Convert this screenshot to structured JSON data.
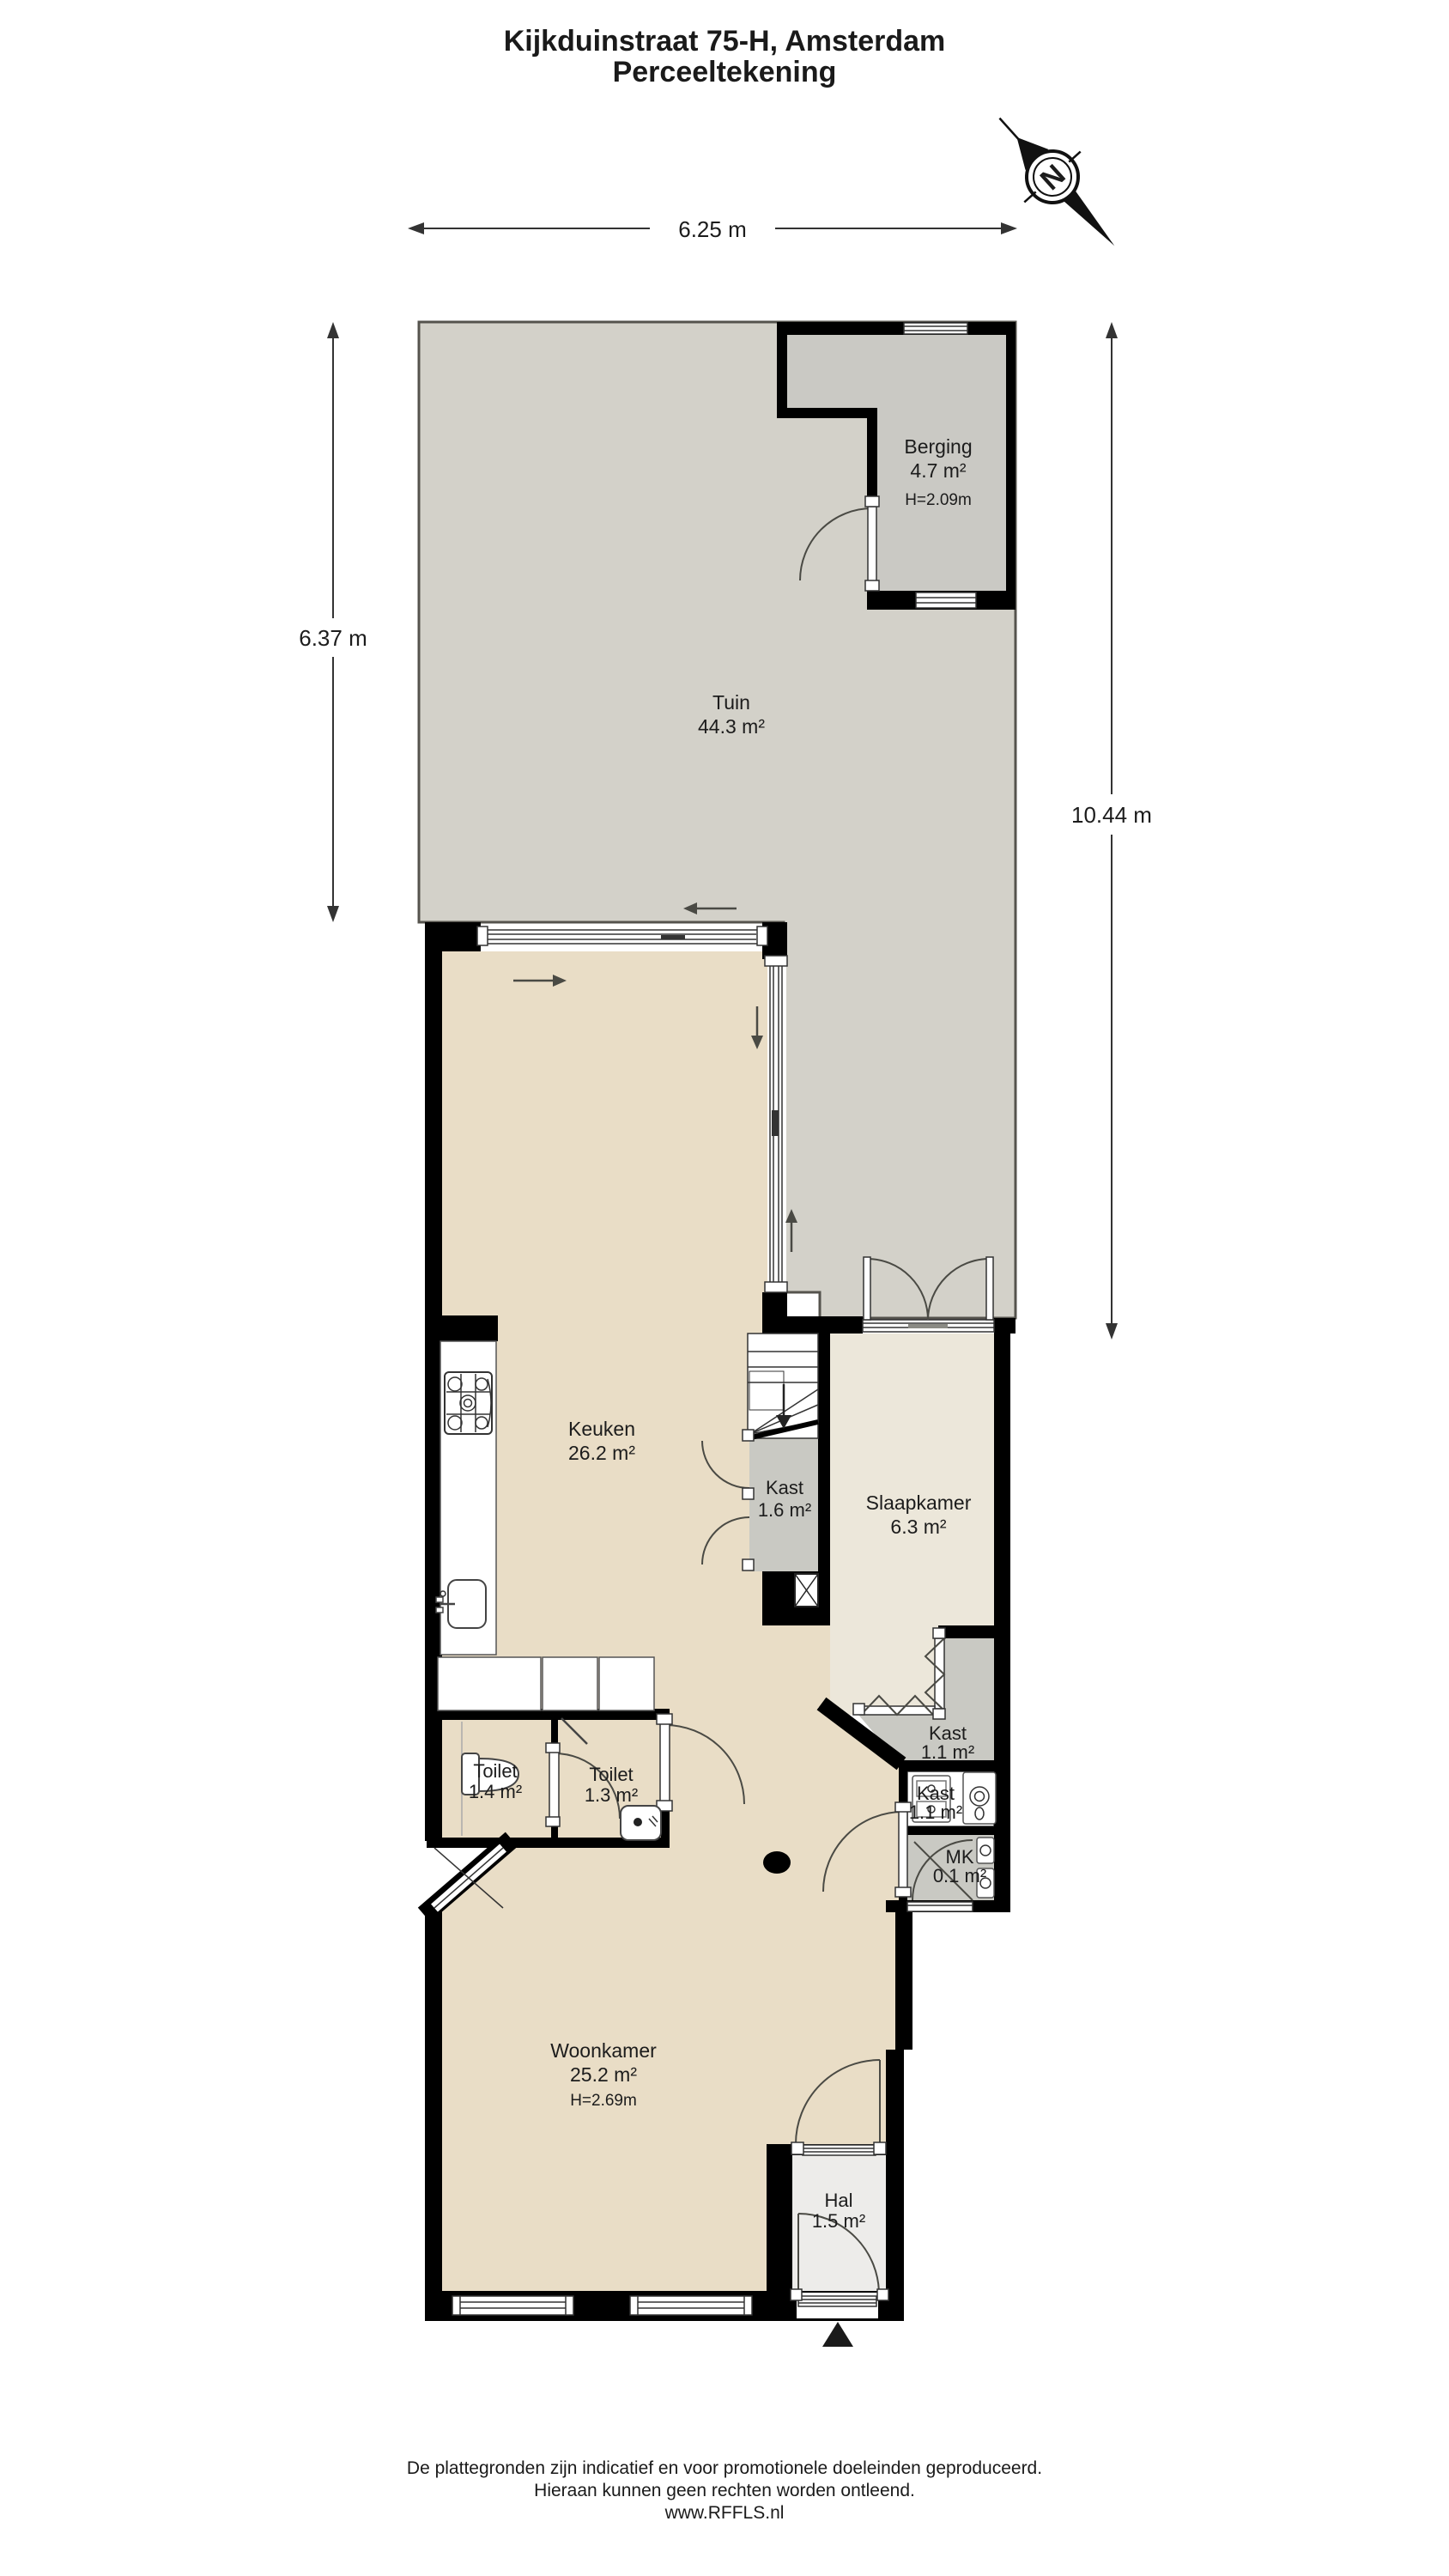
{
  "title": {
    "line1": "Kijkduinstraat 75-H, Amsterdam",
    "line2": "Perceeltekening"
  },
  "compass": {
    "letter": "N"
  },
  "dimensions": {
    "top": "6.25 m",
    "left": "6.37 m",
    "right": "10.44 m"
  },
  "rooms": {
    "berging": {
      "name": "Berging",
      "area": "4.7 m²",
      "height": "H=2.09m"
    },
    "tuin": {
      "name": "Tuin",
      "area": "44.3 m²"
    },
    "keuken": {
      "name": "Keuken",
      "area": "26.2 m²"
    },
    "kast_trap": {
      "name": "Kast",
      "area": "1.6 m²"
    },
    "slaapkamer": {
      "name": "Slaapkamer",
      "area": "6.3 m²"
    },
    "kast_slk": {
      "name": "Kast",
      "area": "1.1 m²"
    },
    "kast_was": {
      "name": "Kast",
      "area": "1.1 m²"
    },
    "mk": {
      "name": "MK",
      "area": "0.1 m²"
    },
    "toilet_l": {
      "name": "Toilet",
      "area": "1.4 m²"
    },
    "toilet_r": {
      "name": "Toilet",
      "area": "1.3 m²"
    },
    "woonkamer": {
      "name": "Woonkamer",
      "area": "25.2 m²",
      "height": "H=2.69m"
    },
    "hal": {
      "name": "Hal",
      "area": "1.5 m²"
    }
  },
  "footer": {
    "line1": "De plattegronden zijn indicatief en voor promotionele doeleinden geproduceerd.",
    "line2": "Hieraan kunnen geen rechten worden ontleend.",
    "line3": "www.RFFLS.nl"
  },
  "colors": {
    "garden": "#d3d1c9",
    "berging": "#cac9c4",
    "floor": "#e9ddc6",
    "slaapkamer": "#ece7da",
    "hal": "#edecea",
    "closet": "#c9c9c3",
    "wall": "#000000"
  }
}
